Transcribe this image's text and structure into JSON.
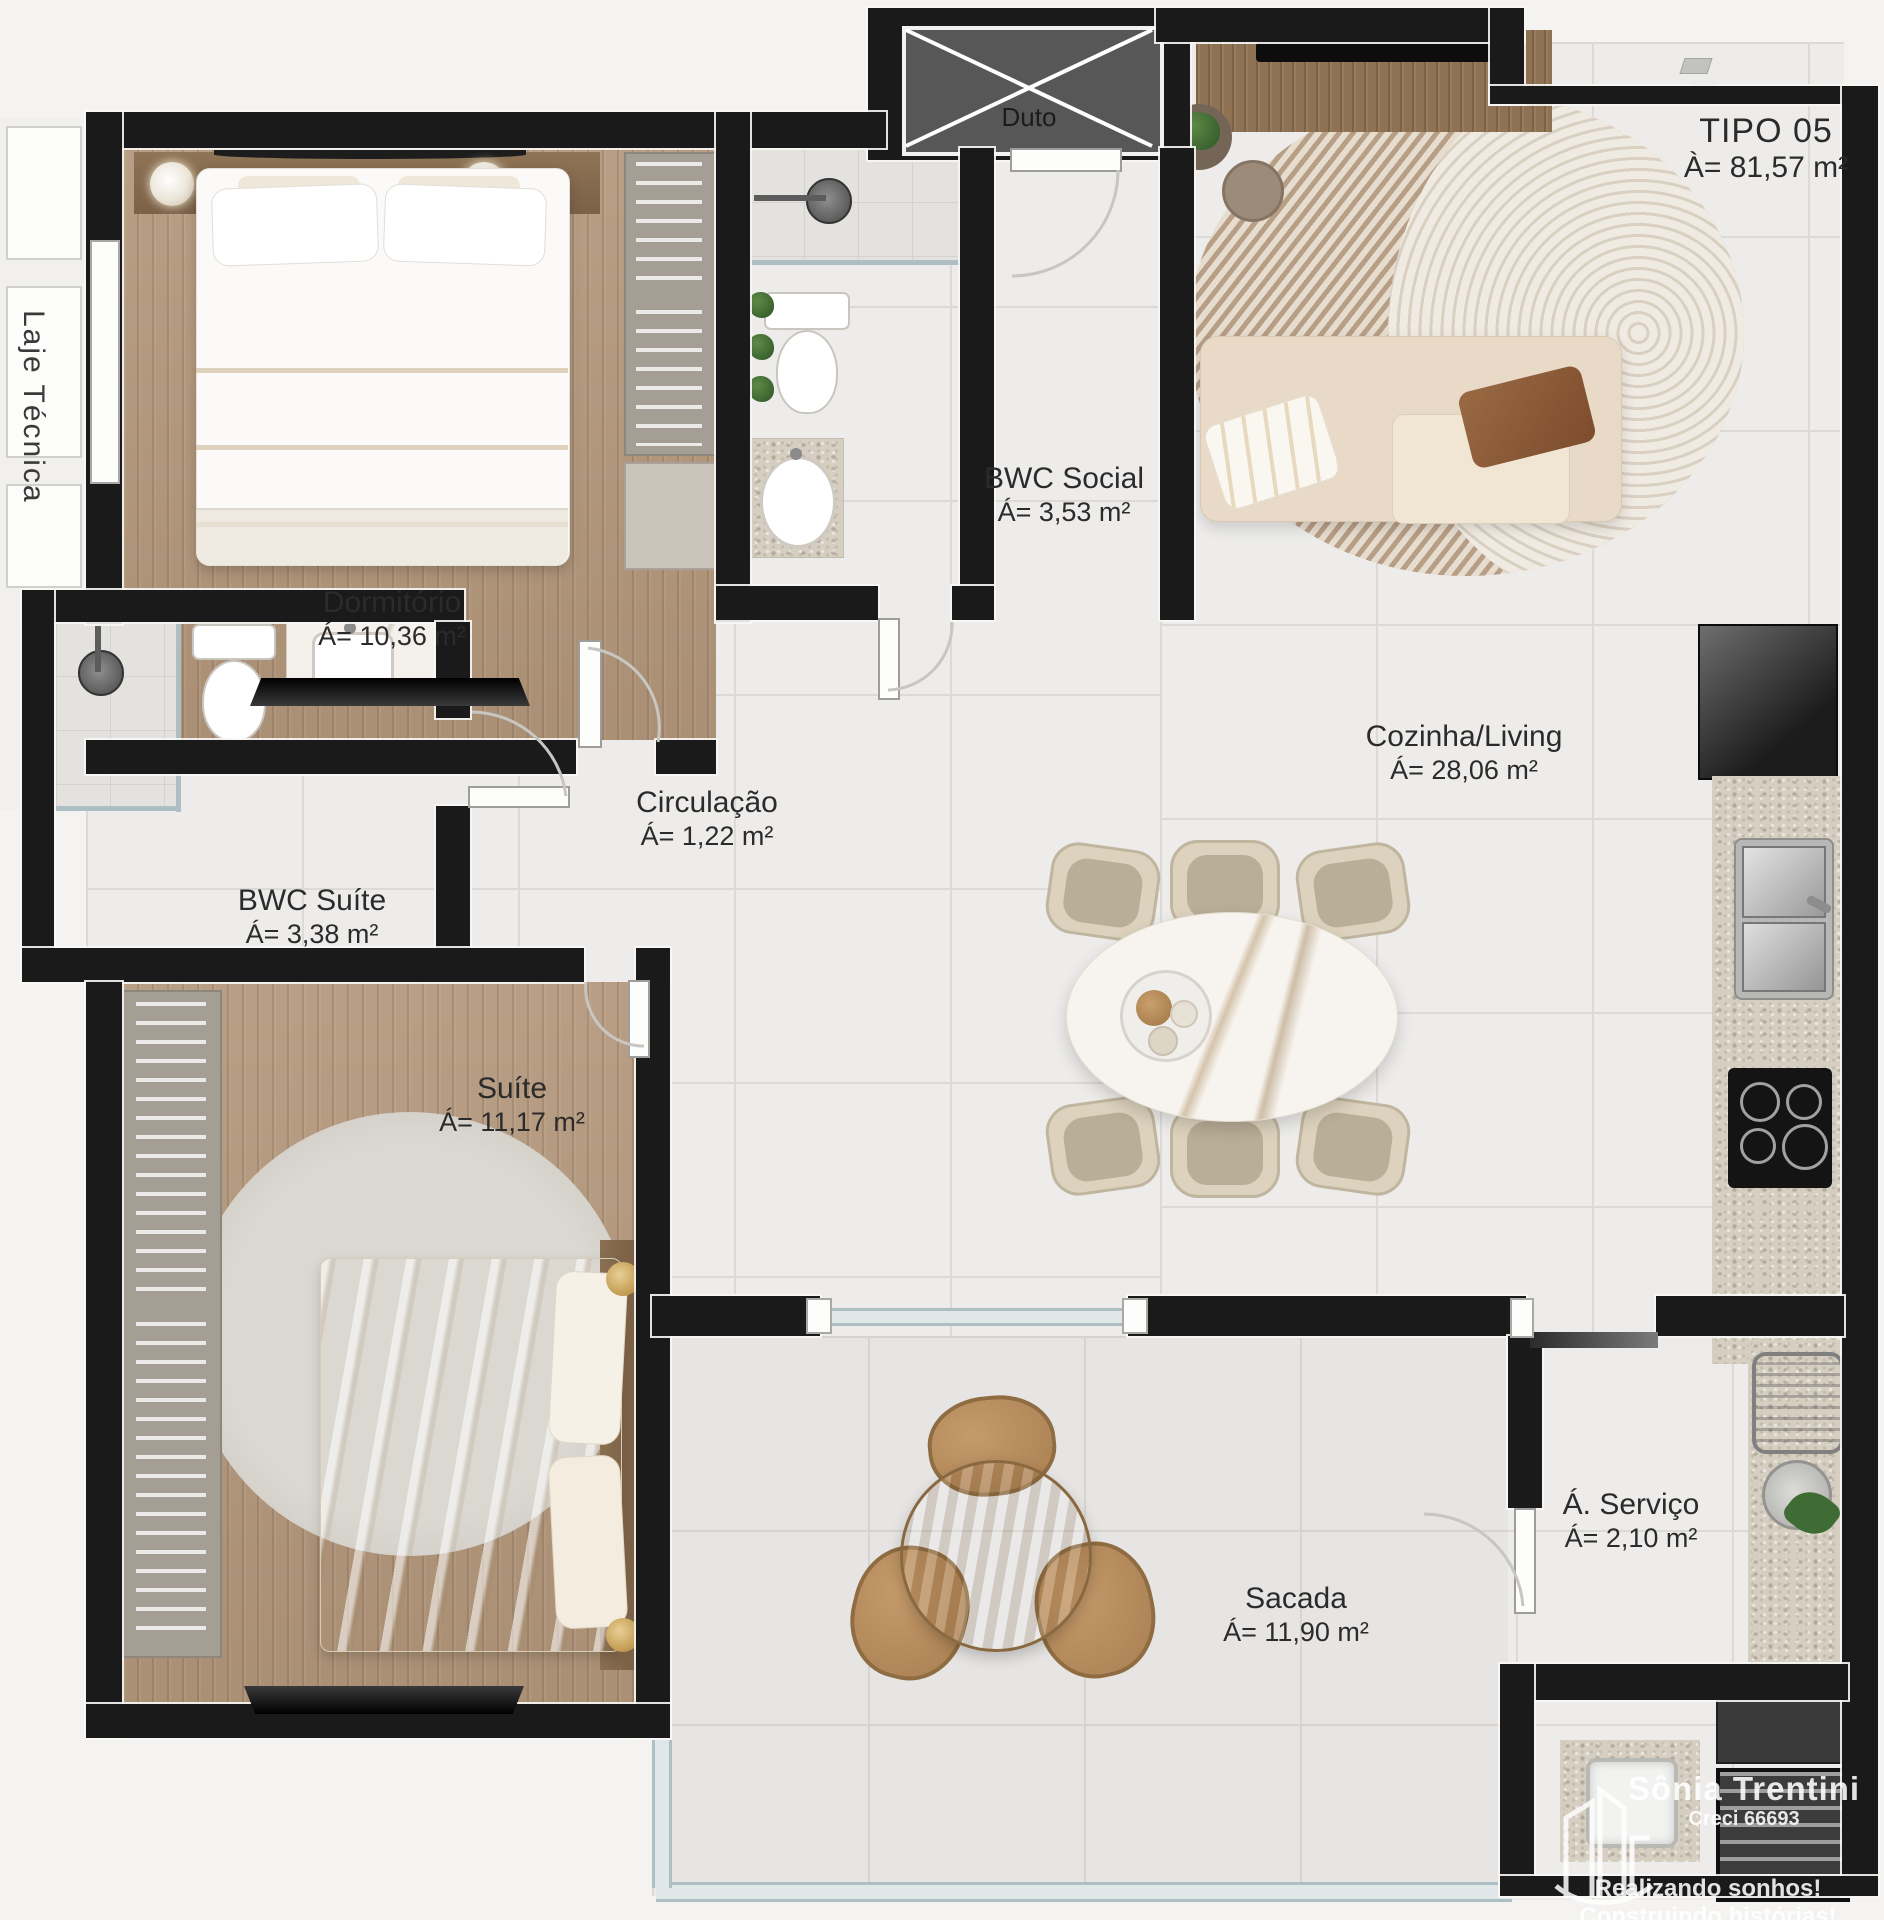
{
  "plan": {
    "type_label": "TIPO 05",
    "type_area": "À= 81,57 m²",
    "duct_label": "Duto",
    "technical_slab_label": "Laje Técnica",
    "rooms": [
      {
        "id": "dormitorio",
        "name": "Dormitório",
        "area": "Á= 10,36 m²"
      },
      {
        "id": "bwc_social",
        "name": "BWC Social",
        "area": "Á= 3,53 m²"
      },
      {
        "id": "circulacao",
        "name": "Circulação",
        "area": "Á= 1,22 m²"
      },
      {
        "id": "bwc_suite",
        "name": "BWC Suíte",
        "area": "Á= 3,38 m²"
      },
      {
        "id": "suite",
        "name": "Suíte",
        "area": "Á= 11,17 m²"
      },
      {
        "id": "cozinha_living",
        "name": "Cozinha/Living",
        "area": "Á= 28,06 m²"
      },
      {
        "id": "sacada",
        "name": "Sacada",
        "area": "Á= 11,90 m²"
      },
      {
        "id": "servico",
        "name": "Á. Serviço",
        "area": "Á= 2,10 m²"
      }
    ]
  },
  "watermark": {
    "name": "Sônia Trentini",
    "license": "Creci 66693",
    "tagline1": "Realizando sonhos!",
    "tagline2": "Construindo histórias!"
  },
  "colors": {
    "wall": "#1a1a1a",
    "wood_floor": "#b3977b",
    "tile_floor": "#edecea",
    "granite": "#d6cfc1",
    "sofa_beige": "#e9dac7",
    "pillow_brown": "#8a5a38",
    "glass_blue": "#aebfc4",
    "rug_stripe": "#b79e86",
    "brass": "#c19a4e"
  }
}
